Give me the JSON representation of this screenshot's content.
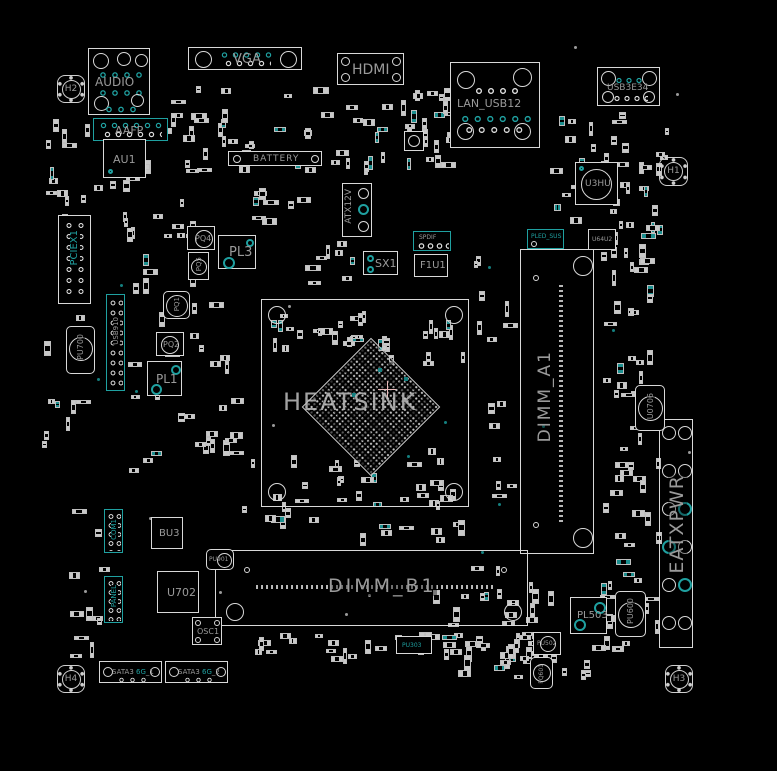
{
  "diagram": {
    "type": "motherboard-boardview",
    "colors": {
      "background": "#000000",
      "outline": "#d8d8d8",
      "label_gray": "#9a9a9a",
      "accent_teal": "#1fa0a0"
    }
  },
  "labels": {
    "audio": "AUDIO",
    "vga": "VGA",
    "hdmi": "HDMI",
    "battery": "BATTERY",
    "lan_usb": "LAN_USB12",
    "usb3": "USB3E34",
    "aafp": "AAFP",
    "atx12v": "ATX12V",
    "pciex1": "PCIEX1",
    "spdif": "SPDIF",
    "sx1": "SX1",
    "f1u1": "F1U1",
    "au1": "AU1",
    "u3hu": "U3HU",
    "u64u2": "U64U2",
    "pled_sus": "PLED_SUS",
    "heatsink": "HEATSINK",
    "dimm_a1": "DIMM_A1",
    "dimm_b1": "DIMM_B1",
    "eatxpwr": "EATXPWR",
    "pq1": "PQ1",
    "pq2": "PQ2",
    "pq4": "PQ4",
    "pq5": "PQ5",
    "pl1": "PL1",
    "pl3": "PL3",
    "pu700": "PU700",
    "usb910": "USB910",
    "u0706": "U0706",
    "pu600": "PU600",
    "pl503": "PL503",
    "pu502": "PU502",
    "pq601": "PQ601",
    "pu303": "PU303",
    "pu901": "PU901",
    "bu3": "BU3",
    "u702": "U702",
    "osc1": "OSC1",
    "com1": "COM1",
    "panel": "PANEL",
    "h1": "H1",
    "h2": "H2",
    "h3": "H3",
    "h4": "H4",
    "sata1": {
      "pre": "SATA3",
      "mid": "6G",
      "suf": "_1"
    },
    "sata2": {
      "pre": "SATA3",
      "mid": "6G",
      "suf": "_2"
    }
  }
}
